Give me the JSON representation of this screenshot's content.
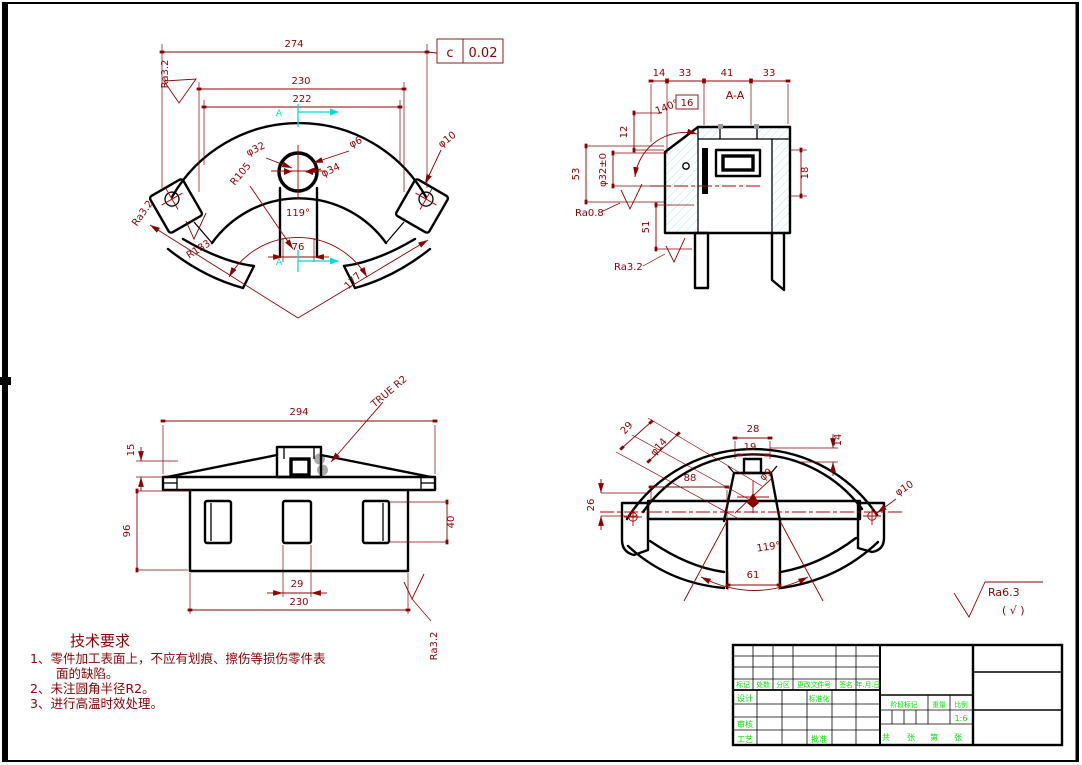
{
  "colors": {
    "geometry": "#000000",
    "dimension": "#8b0000",
    "section_marks": "#00dcdc",
    "titleblock_text": "#00e400",
    "highlight": "#a9a9a9",
    "background": "#ffffff"
  },
  "tolerance_frame": {
    "datum": "c",
    "value": "0.02"
  },
  "front_view": {
    "d274": "274",
    "d230": "230",
    "d222": "222",
    "phi32": "φ32",
    "phi6": "φ6",
    "phi34": "φ34",
    "phi10": "φ10",
    "r105": "R105",
    "r183": "R183",
    "angle119": "119°",
    "d76": "76",
    "d177": "177",
    "ra32": "Ra3.2",
    "section_label": "A"
  },
  "section_view": {
    "label": "A-A",
    "d14": "14",
    "d33a": "33",
    "d41": "41",
    "d33b": "33",
    "d16": "16",
    "angle140": "140°",
    "d12": "12",
    "d53": "53",
    "phi32tol": "φ32±0",
    "d51": "51",
    "d18": "18",
    "ra08": "Ra0.8",
    "ra32": "Ra3.2"
  },
  "side_view": {
    "d294": "294",
    "d15": "15",
    "true_r2": "TRUE R2",
    "d96": "96",
    "d29": "29",
    "d230": "230",
    "d40": "40",
    "ra32": "Ra3.2"
  },
  "bottom_view": {
    "d29": "29",
    "phi14": "φ14",
    "d28": "28",
    "d19": "19",
    "d14": "14",
    "d88": "88",
    "phi9": "φ9",
    "d26": "26",
    "phi10": "φ10",
    "angle119": "119°",
    "d61": "61"
  },
  "general_roughness": {
    "value": "Ra6.3",
    "bracket": "( √ )"
  },
  "tech_requirements": {
    "title": "技术要求",
    "lines": [
      "1、零件加工表面上，不应有划痕、擦伤等损伤零件表",
      "面的缺陷。",
      "2、未注圆角半径R2。",
      "3、进行高温时效处理。"
    ]
  },
  "title_block": {
    "rev_cols": [
      "标记",
      "处数",
      "分区",
      "更改文件号",
      "签名",
      "年.月.日"
    ],
    "design": "设计",
    "standardize": "标准化",
    "audit": "审核",
    "craft": "工艺",
    "approve": "批准",
    "stage": "阶段标记",
    "weight": "重量",
    "scale": "比例",
    "scale_value": "1:6",
    "sheet_words": [
      "共",
      "张",
      "第",
      "张"
    ]
  }
}
